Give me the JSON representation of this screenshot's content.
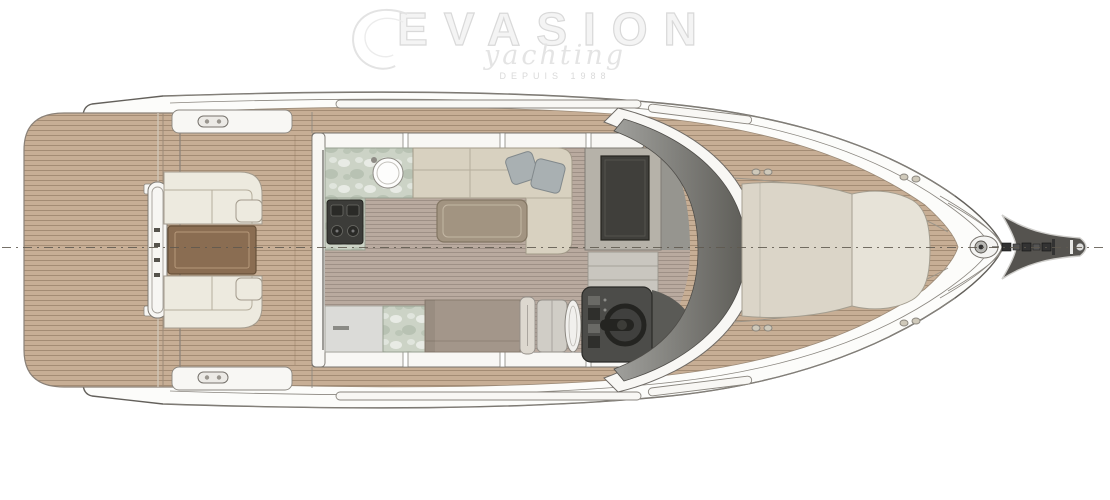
{
  "watermark": {
    "brand": "EVASION",
    "script": "yachting",
    "tagline": "DEPUIS 1988"
  },
  "colors": {
    "deck-wood": "#c7ae95",
    "deck-line": "#8a7560",
    "floor-wood": "#b9aa9f",
    "hull-white": "#fcfcfa",
    "outline": "#6b6863",
    "outline-dark": "#4a4843",
    "gunwale": "#f8f7f4",
    "sofa-cream": "#edeadf",
    "sofa-beige": "#d8d1c0",
    "cushion-line": "#a39b8d",
    "marble": "#ccd3c6",
    "marble-line": "#99a092",
    "table-cockpit": "#8a6d52",
    "table-salon": "#a29481",
    "bench-taupe": "#a3968a",
    "pillow-grey": "#a9b0b2",
    "tv-frame": "#b6b2a9",
    "tv-screen": "#403f3b",
    "console-dark": "#4c4c49",
    "wheel-dark": "#242421",
    "windshield-light": "#a0a09c",
    "windshield-dark": "#5e5d58",
    "sunpad": "#dbd5c8",
    "sunpad-light": "#e7e3d8",
    "counter-grey": "#dbdbd8",
    "steps-grey": "#c9c6bf",
    "sprit-dark": "#55534f",
    "watermark": "#e2e2e2",
    "centerline": "#5f594f"
  }
}
